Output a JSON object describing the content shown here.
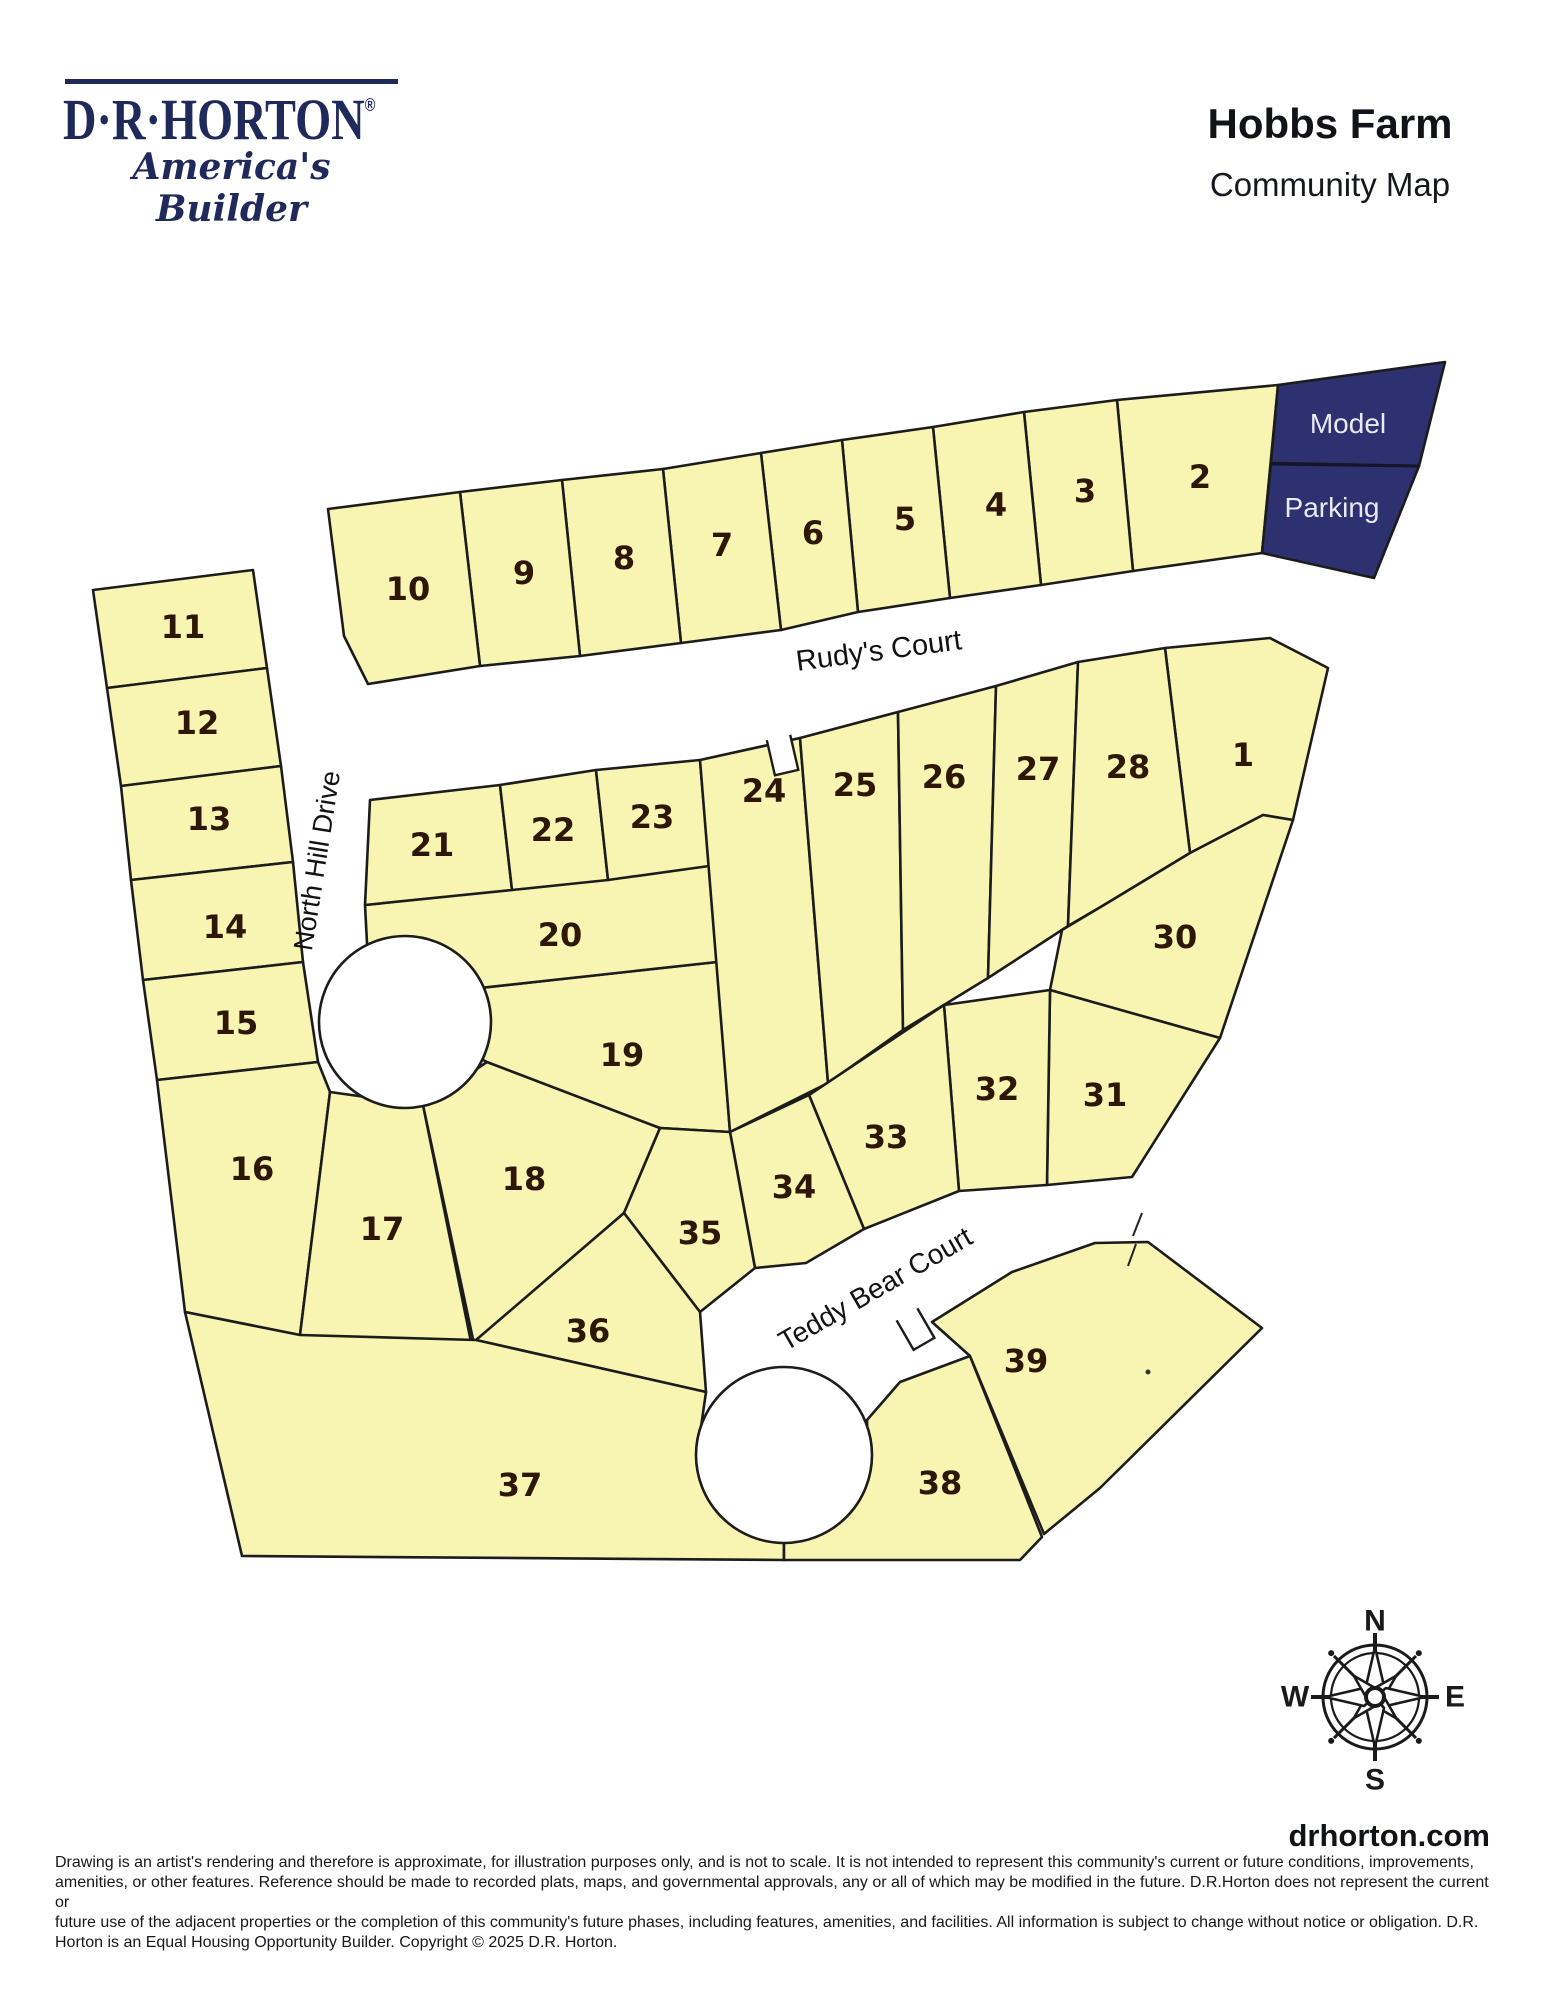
{
  "header": {
    "logo_wordmark": "D·R·HORTON",
    "logo_registered": "®",
    "logo_tagline": "America's Builder",
    "title": "Hobbs Farm",
    "subtitle": "Community Map"
  },
  "map": {
    "colors": {
      "lot_fill": "#f7f5b1",
      "lot_stroke": "#1c1c1c",
      "number_color": "#2e1608",
      "model_fill": "#2e3170",
      "model_text": "#e9e9f2",
      "street_text": "#121212"
    },
    "lots": [
      {
        "n": "1",
        "lx": 1243,
        "ly": 766,
        "pts": "1165,648 1270,638 1328,668 1293,820 1263,815 1190,853"
      },
      {
        "n": "2",
        "lx": 1200,
        "ly": 488,
        "pts": "1117,400 1278,385 1262,553 1133,571"
      },
      {
        "n": "3",
        "lx": 1085,
        "ly": 502,
        "pts": "1024,412 1117,400 1133,571 1041,585"
      },
      {
        "n": "4",
        "lx": 996,
        "ly": 516,
        "pts": "933,427 1024,412 1041,585 950,598"
      },
      {
        "n": "5",
        "lx": 905,
        "ly": 530,
        "pts": "842,440 933,427 950,598 858,612"
      },
      {
        "n": "6",
        "lx": 813,
        "ly": 544,
        "pts": "761,453 842,440 858,612 781,630"
      },
      {
        "n": "7",
        "lx": 722,
        "ly": 556,
        "pts": "663,469 761,453 781,630 681,643"
      },
      {
        "n": "8",
        "lx": 624,
        "ly": 569,
        "pts": "562,480 663,469 681,643 580,656"
      },
      {
        "n": "9",
        "lx": 524,
        "ly": 584,
        "pts": "460,492 562,480 580,656 480,666"
      },
      {
        "n": "10",
        "lx": 408,
        "ly": 600,
        "pts": "328,509 460,492 480,666 368,684 344,636"
      },
      {
        "n": "11",
        "lx": 183,
        "ly": 638,
        "pts": "93,590 253,570 267,668 107,688"
      },
      {
        "n": "12",
        "lx": 197,
        "ly": 734,
        "pts": "107,688 267,668 281,766 121,786"
      },
      {
        "n": "13",
        "lx": 209,
        "ly": 830,
        "pts": "121,786 281,766 293,862 131,880"
      },
      {
        "n": "14",
        "lx": 225,
        "ly": 938,
        "pts": "131,880 293,862 303,962 143,980"
      },
      {
        "n": "15",
        "lx": 236,
        "ly": 1034,
        "pts": "143,980 303,962 318,1062 157,1080"
      },
      {
        "n": "16",
        "lx": 252,
        "ly": 1180,
        "pts": "157,1080 318,1062 330,1092 300,1335 185,1312"
      },
      {
        "n": "17",
        "lx": 382,
        "ly": 1240,
        "pts": "330,1092 423,1105 472,1347 300,1335"
      },
      {
        "n": "18",
        "lx": 524,
        "ly": 1190,
        "pts": "423,1105 487,1062 660,1128 624,1213 474,1344"
      },
      {
        "n": "19",
        "lx": 622,
        "ly": 1066,
        "pts": "370,1000 717,962 730,1132 660,1128 487,1062 428,1032"
      },
      {
        "n": "20",
        "lx": 560,
        "ly": 946,
        "pts": "365,905 709,866 717,962 370,1000"
      },
      {
        "n": "21",
        "lx": 432,
        "ly": 856,
        "pts": "370,800 500,785 512,890 365,905"
      },
      {
        "n": "22",
        "lx": 553,
        "ly": 841,
        "pts": "500,785 596,770 608,880 512,890"
      },
      {
        "n": "23",
        "lx": 652,
        "ly": 828,
        "pts": "596,770 700,760 709,866 608,880"
      },
      {
        "n": "24",
        "lx": 764,
        "ly": 802,
        "pts": "700,760 800,738 828,1083 730,1132"
      },
      {
        "n": "25",
        "lx": 855,
        "ly": 796,
        "pts": "800,738 898,712 903,1030 828,1083"
      },
      {
        "n": "26",
        "lx": 944,
        "ly": 788,
        "pts": "898,712 996,686 988,978 903,1030"
      },
      {
        "n": "27",
        "lx": 1038,
        "ly": 780,
        "pts": "996,686 1078,662 1068,926 988,978"
      },
      {
        "n": "28",
        "lx": 1128,
        "ly": 778,
        "pts": "1078,662 1165,648 1190,853 1104,905 1068,926"
      },
      {
        "n": "30",
        "lx": 1175,
        "ly": 948,
        "pts": "1062,930 1104,905 1190,853 1263,815 1293,820 1220,1038 1050,990"
      },
      {
        "n": "31",
        "lx": 1105,
        "ly": 1106,
        "pts": "1050,990 1220,1038 1132,1177 1047,1185"
      },
      {
        "n": "32",
        "lx": 997,
        "ly": 1100,
        "pts": "944,1005 1050,990 1047,1185 959,1191"
      },
      {
        "n": "33",
        "lx": 886,
        "ly": 1148,
        "pts": "809,1095 944,1005 959,1191 864,1229"
      },
      {
        "n": "34",
        "lx": 794,
        "ly": 1198,
        "pts": "730,1132 809,1095 864,1229 806,1263 755,1268"
      },
      {
        "n": "35",
        "lx": 700,
        "ly": 1244,
        "pts": "660,1128 730,1132 755,1268 700,1312 624,1213"
      },
      {
        "n": "36",
        "lx": 588,
        "ly": 1342,
        "pts": "476,1340 624,1213 700,1312 706,1392"
      },
      {
        "n": "37",
        "lx": 520,
        "ly": 1496,
        "pts": "185,1312 300,1335 476,1340 706,1392 697,1455 720,1515 784,1543 784,1560 242,1556"
      },
      {
        "n": "38",
        "lx": 940,
        "ly": 1494,
        "pts": "784,1543 845,1505 868,1460 867,1420 900,1382 970,1356 1042,1537 1020,1560 784,1560"
      },
      {
        "n": "39",
        "lx": 1026,
        "ly": 1372,
        "pts": "932,1322 1012,1272 1095,1243 1148,1242 1262,1328 1100,1488 1044,1534 970,1356"
      }
    ],
    "special_areas": [
      {
        "id": "model",
        "label": "Model",
        "lx": 1348,
        "ly": 433,
        "pts": "1278,385 1445,362 1419,466 1271,463"
      },
      {
        "id": "parking",
        "label": "Parking",
        "lx": 1332,
        "ly": 517,
        "pts": "1271,463 1419,466 1374,578 1262,553"
      }
    ],
    "special_divider": {
      "x1": 1271,
      "y1": 464,
      "x2": 1419,
      "y2": 466
    },
    "streets": [
      {
        "id": "rudys-court",
        "name": "Rudy's Court",
        "x": 880,
        "y": 660,
        "rotate": -7.5,
        "size": 29
      },
      {
        "id": "north-hill-drive",
        "name": "North Hill Drive",
        "x": 326,
        "y": 862,
        "rotate": -81,
        "size": 27
      },
      {
        "id": "teddy-bear-court",
        "name": "Teddy Bear Court",
        "x": 880,
        "y": 1297,
        "rotate": -30,
        "size": 28
      }
    ],
    "culdesacs": [
      {
        "id": "north-hill-bulb",
        "cx": 405,
        "cy": 1022,
        "r": 86
      },
      {
        "id": "teddy-bear-bulb",
        "cx": 784,
        "cy": 1455,
        "r": 88
      }
    ],
    "notches": [
      {
        "id": "rudys-court-notch",
        "tx": 783,
        "ty": 757,
        "rot": -13,
        "d": "M -12 -20 L -12 16 L 12 16 L 12 -20"
      },
      {
        "id": "teddy-bear-notch",
        "tx": 916,
        "ty": 1330,
        "rot": -30,
        "d": "M -12 -18 L -12 16 L 12 16 L 12 -18"
      }
    ],
    "tick_marks": [
      {
        "x1": 1142,
        "y1": 1213,
        "x2": 1133,
        "y2": 1236
      },
      {
        "x1": 1136,
        "y1": 1244,
        "x2": 1128,
        "y2": 1266
      }
    ],
    "dot_mark": {
      "cx": 1148,
      "cy": 1372,
      "r": 2.5
    }
  },
  "compass": {
    "cx": 1375,
    "cy": 1697,
    "n": "N",
    "e": "E",
    "s": "S",
    "w": "W"
  },
  "footer": {
    "website": "drhorton.com",
    "disclaimer_lines": [
      "Drawing is an artist's rendering and therefore is approximate, for illustration purposes only, and is not to scale. It is not intended to represent this community's current or future conditions, improvements,",
      "amenities, or other features. Reference should be made to recorded plats, maps, and governmental approvals, any or all of which may be modified in the future. D.R.Horton does not represent the current or",
      "future use of the adjacent properties or the completion of this community's future phases, including features, amenities, and facilities. All information is subject to change without notice or obligation. D.R.",
      "Horton is an Equal Housing Opportunity Builder. Copyright © 2025 D.R. Horton."
    ]
  }
}
